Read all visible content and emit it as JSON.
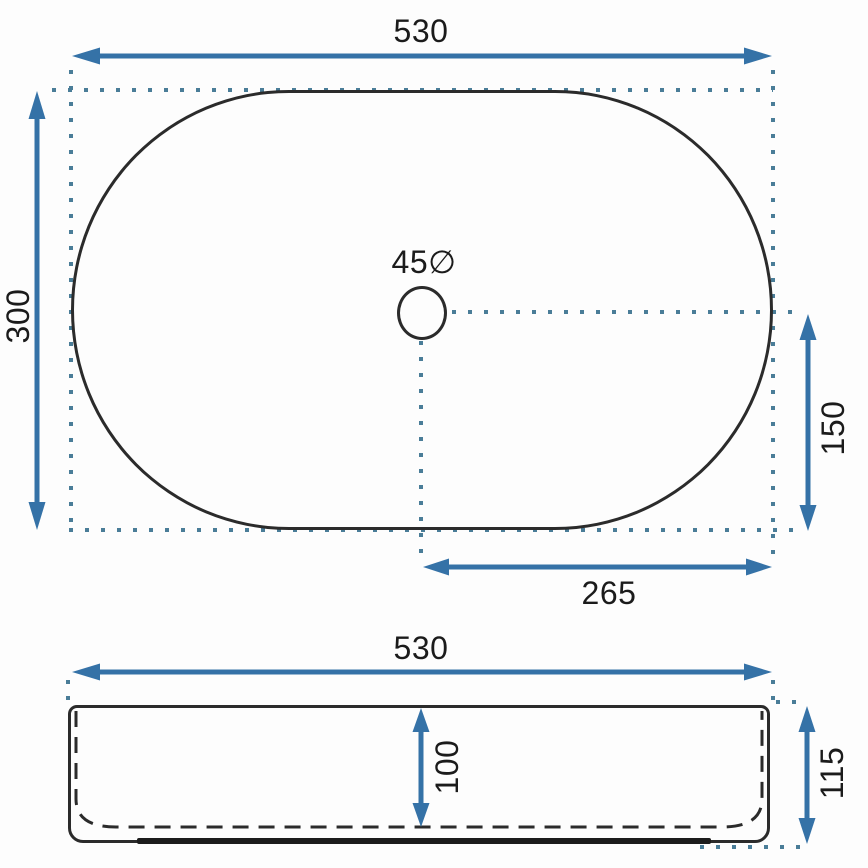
{
  "top_view": {
    "width": "530",
    "height": "300",
    "drain_diameter": "45∅",
    "drain_offset_vertical": "150",
    "drain_offset_horizontal": "265"
  },
  "side_view": {
    "width": "530",
    "inner_depth": "100",
    "overall_height": "115"
  },
  "colors": {
    "dimension_blue": "#3572a7",
    "dot_blue": "#4a7d98",
    "outline_dark": "#2b2b2b"
  }
}
